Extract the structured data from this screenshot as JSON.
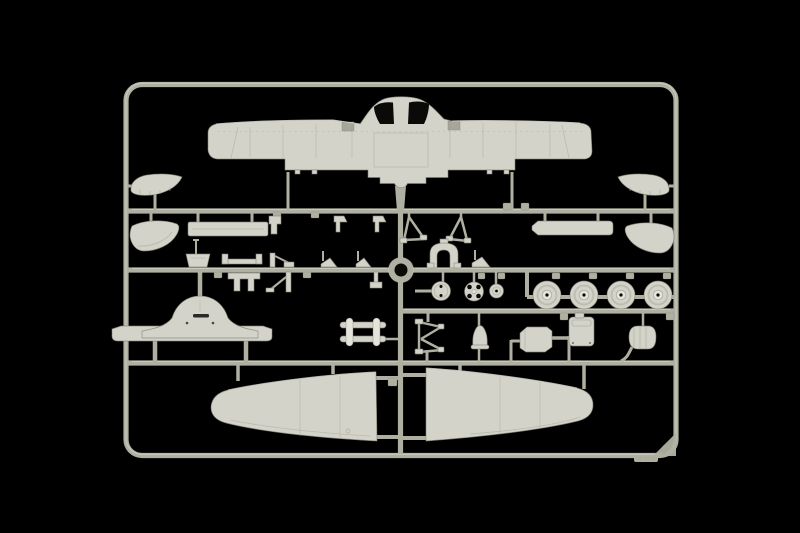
{
  "scene": {
    "type": "photograph",
    "subject": "Injection-molded light grey plastic model aircraft sprue photographed on a black background",
    "background": "black studio backdrop",
    "plastic_finish": "light grey styrene"
  },
  "colors": {
    "bg": "#000000",
    "rail": "#b0b0a2",
    "rail_hi": "#e2e2d6",
    "rail_sh": "#6a6a5f",
    "plastic": "#d3d3ca",
    "plastic_light": "#e4e4db",
    "plastic_shadow": "#a7a799",
    "plastic_edge": "#828276",
    "hole": "#0a0a08",
    "panel": "#97978a"
  },
  "sprue": {
    "frame_shape": "rounded rectangle runner frame",
    "runner_rows": 4,
    "wheel_count": 4,
    "parts": {
      "upper_wing": "one-piece upper wing with open cockpit cut-outs",
      "lower_wing_left": "left lower wing half",
      "lower_wing_right": "right lower wing half",
      "wheels": "four main wheels with hubs",
      "bulkhead": "bell-shaped fuselage bulkhead on curved carrier bar",
      "fairings": "four curved wing-root fairing pieces",
      "spar_bar": "long rectangular spar strip",
      "flat_strip": "tapered flat strip",
      "gear_struts": "two V-shaped landing-gear struts",
      "arch": "arched engine-mount part",
      "spinner_backplate": "propeller backplate with shaft",
      "hub_wheel": "small spoked hub wheel",
      "small_disc": "small ringed disc",
      "exhaust_rack": "ladder-shaped exhaust rack",
      "k_frame": "K-shaped retraction frame",
      "bell_mount": "small bell-shaped mount",
      "tank_box": "angular tank box",
      "lid_box": "rounded box with lid",
      "cowl_scoop": "rounded cowl scoop with curved arm",
      "brackets": "assorted small brackets, wedges and clips",
      "mold_mark": "molded chevron mark in bottom-right frame corner",
      "brand_tab": "embossed maker tab on bottom rail"
    }
  }
}
